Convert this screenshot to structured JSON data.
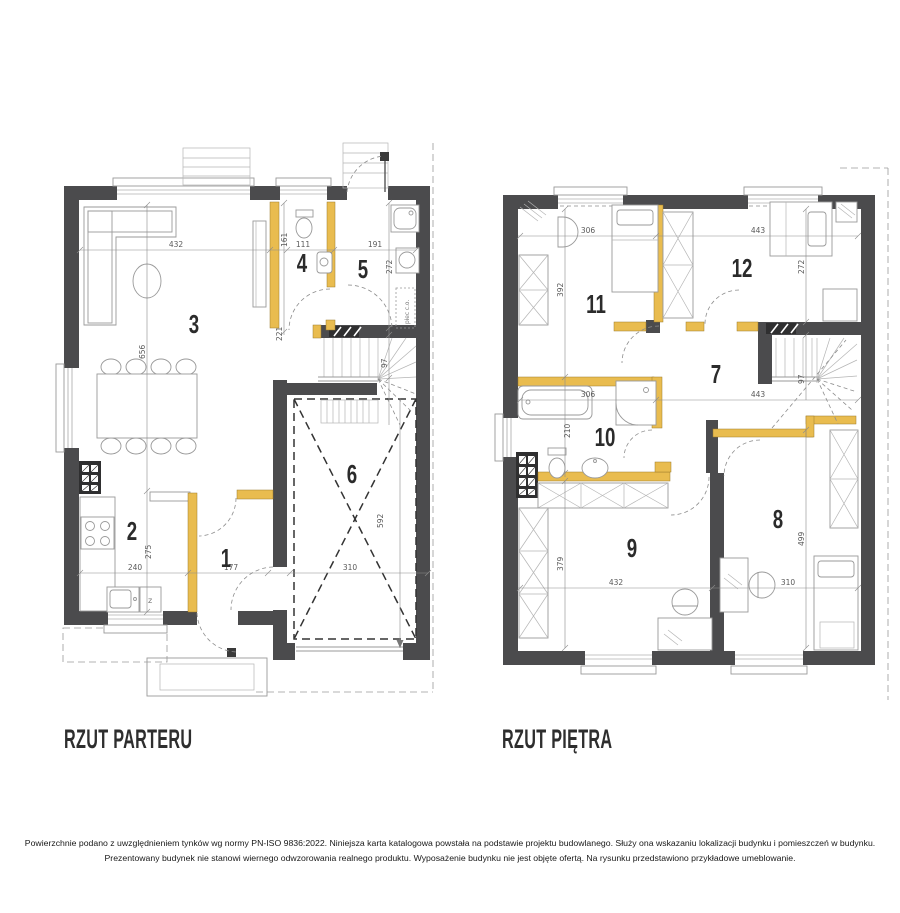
{
  "plans": {
    "parter": {
      "title": "RZUT PARTERU",
      "rooms": {
        "r1": "1",
        "r2": "2",
        "r3": "3",
        "r4": "4",
        "r5": "5",
        "r6": "6"
      },
      "dims": {
        "w432": "432",
        "w161": "161",
        "w111": "111",
        "w191": "191",
        "h272": "272",
        "h656": "656",
        "h221": "221",
        "h97": "97",
        "h275": "275",
        "w240": "240",
        "w177": "177",
        "w310": "310",
        "h592": "592"
      },
      "labels": {
        "furnace": "piec c.o.",
        "dishwasher": "z"
      }
    },
    "pietro": {
      "title": "RZUT PIĘTRA",
      "rooms": {
        "r7": "7",
        "r8": "8",
        "r9": "9",
        "r10": "10",
        "r11": "11",
        "r12": "12"
      },
      "dims": {
        "w306a": "306",
        "w443a": "443",
        "h392": "392",
        "h272": "272",
        "w306b": "306",
        "w443b": "443",
        "h210": "210",
        "h97": "97",
        "h379": "379",
        "w432": "432",
        "w310": "310",
        "h499": "499"
      }
    }
  },
  "footer": {
    "line1": "Powierzchnie podano z uwzględnieniem tynków wg normy PN-ISO 9836:2022. Niniejsza karta katalogowa powstała na podstawie projektu budowlanego. Służy ona wskazaniu lokalizacji budynku i pomieszczeń w budynku.",
    "line2": "Prezentowany budynek nie stanowi wiernego odwzorowania realnego produktu. Wyposażenie budynku nie jest objęte ofertą. Na rysunku przedstawiono przykładowe umeblowanie."
  },
  "colors": {
    "wall": "#4b4b4d",
    "accent": "#e9bc4f",
    "line": "#9a9a9a"
  }
}
